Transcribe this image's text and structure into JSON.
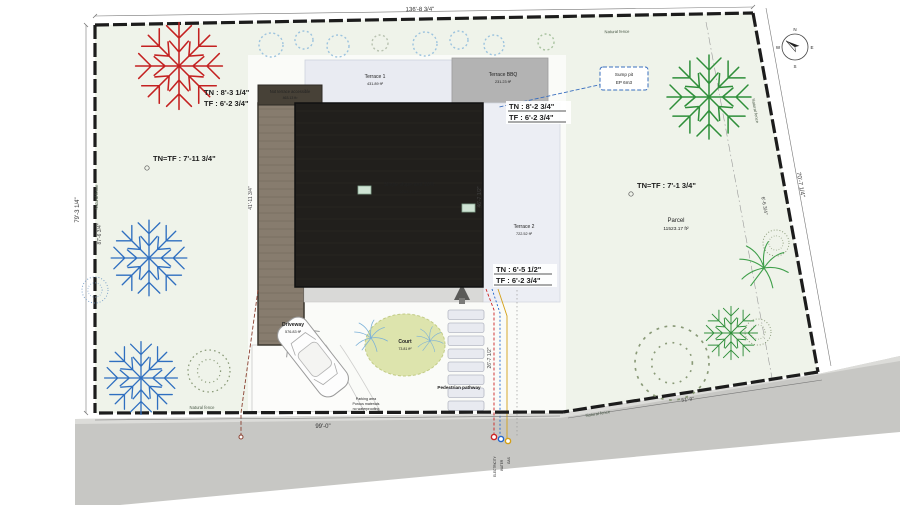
{
  "plan": {
    "dims": {
      "top": "136'-8 3/4\"",
      "left": "79'-3 1/4\"",
      "left_inner": "87'-6 3/4\"",
      "right": "70'-7 1/4\"",
      "right_inner": "6'-6 3/4\"",
      "bottom": "99'-0\"",
      "bottom_right": "51'-9\"",
      "house_left": "41'-11 3/4\"",
      "roof_right": "46'-7 1/2\"",
      "pathway": "26'-7 1/2\""
    },
    "levels": {
      "nw": {
        "tn": "TN : 8'-3 1/4\"",
        "tf": "TF : 6'-2 3/4\""
      },
      "w": {
        "text": "TN=TF : 7'-11 3/4\""
      },
      "c": {
        "tn": "TN : 8'-2 3/4\"",
        "tf": "TF : 6'-2 3/4\""
      },
      "e": {
        "text": "TN=TF : 7'-1 3/4\""
      },
      "s": {
        "tn": "TN : 6'-5 1/2\"",
        "tf": "TF : 6'-2 3/4\""
      }
    },
    "areas": {
      "terrace1": {
        "name": "Terrace 1",
        "area": "431.89 ft²"
      },
      "terrace_bbq": {
        "name": "Terrace BBQ",
        "area": "231.23 ft²"
      },
      "terrace2": {
        "name": "Terrace 2",
        "area": "722.52 ft²"
      },
      "roof": {
        "name": "Single slope roof 10%",
        "area": "5230.13 ft²"
      },
      "deck": {
        "name": "Not terrace accessible",
        "area": "463.13 ft²"
      },
      "driveway": {
        "name": "Driveway",
        "area": "576.83 ft²"
      },
      "court": {
        "name": "Court",
        "area": "73.81 ft²"
      },
      "parcel": {
        "name": "Parcel",
        "area": "11523.17 ft²"
      }
    },
    "sump_pit": {
      "line1": "Sump pit",
      "line2": "EP 6m3"
    },
    "fence_label": "Natural fence",
    "pathway_label": "Pedestrian pathway",
    "parking_note": {
      "l1": "Parking area",
      "l2": "Porous materials",
      "l3": "no waterproofing"
    },
    "utilities": {
      "electricity": "ELECTRICITY",
      "water": "WATER",
      "gas": "GAS"
    },
    "compass": {
      "n": "N",
      "e": "E",
      "s": "S",
      "w": "W"
    },
    "colors": {
      "electricity": "#cc2222",
      "water": "#2266cc",
      "gas": "#d4a017",
      "sump_pit": "#3a6fbf",
      "roof": "#211f1c",
      "tree_red": "#c42121",
      "tree_blue": "#2f6fc0",
      "tree_green": "#2f8f3a"
    }
  }
}
